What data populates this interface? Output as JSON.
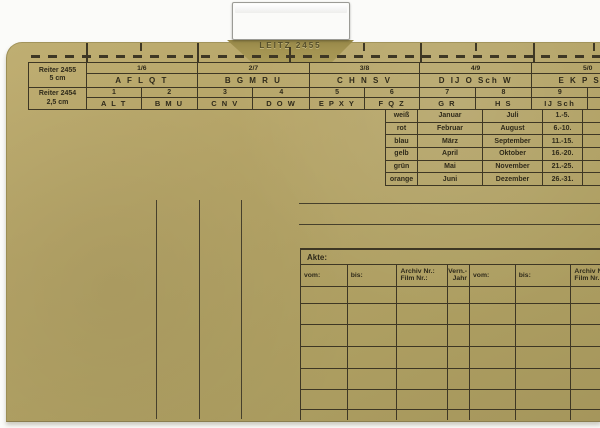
{
  "colors": {
    "folder": "#b5a467",
    "background": "#fbfbf9",
    "line": "#3e3724",
    "text": "#2f2a1a",
    "clip_metal": "#dddad4",
    "tab_cardboard": "#a39351"
  },
  "clip": {
    "label": "LEITZ 2455"
  },
  "index_table": {
    "row_labels": [
      {
        "line1": "Reiter 2455",
        "line2": "5 cm"
      },
      {
        "line1": "Reiter 2454",
        "line2": "2,5 cm"
      }
    ],
    "fractions": [
      "1/6",
      "2/7",
      "3/8",
      "4/9",
      "5/0"
    ],
    "letter_groups": [
      "A F L Q T",
      "B G M R U",
      "C H N S V",
      "D IJ O Sch W",
      "E K P St X"
    ],
    "numbers": [
      "1",
      "2",
      "3",
      "4",
      "5",
      "6",
      "7",
      "8",
      "9",
      ""
    ],
    "subgroups": [
      "A L T",
      "B M U",
      "C N V",
      "D O W",
      "E P X Y",
      "F Q Z",
      "G R",
      "H S",
      "IJ Sch",
      ""
    ]
  },
  "color_month_table": {
    "rows": [
      {
        "color": "weiß",
        "month1": "Januar",
        "month2": "Juli",
        "days": "1.-5."
      },
      {
        "color": "rot",
        "month1": "Februar",
        "month2": "August",
        "days": "6.-10."
      },
      {
        "color": "blau",
        "month1": "März",
        "month2": "September",
        "days": "11.-15."
      },
      {
        "color": "gelb",
        "month1": "April",
        "month2": "Oktober",
        "days": "16.-20."
      },
      {
        "color": "grün",
        "month1": "Mai",
        "month2": "November",
        "days": "21.-25."
      },
      {
        "color": "orange",
        "month1": "Juni",
        "month2": "Dezember",
        "days": "26.-31."
      }
    ]
  },
  "akte_table": {
    "title": "Akte:",
    "columns": [
      {
        "line1": "vom:",
        "line2": ""
      },
      {
        "line1": "bis:",
        "line2": ""
      },
      {
        "line1": "Archiv Nr.:",
        "line2": "Film Nr.:"
      },
      {
        "line1": "Vern.-",
        "line2": "Jahr"
      },
      {
        "line1": "vom:",
        "line2": ""
      },
      {
        "line1": "bis:",
        "line2": ""
      },
      {
        "line1": "Archiv Nr.:",
        "line2": "Film Nr.:"
      }
    ],
    "empty_row_count": 7
  }
}
